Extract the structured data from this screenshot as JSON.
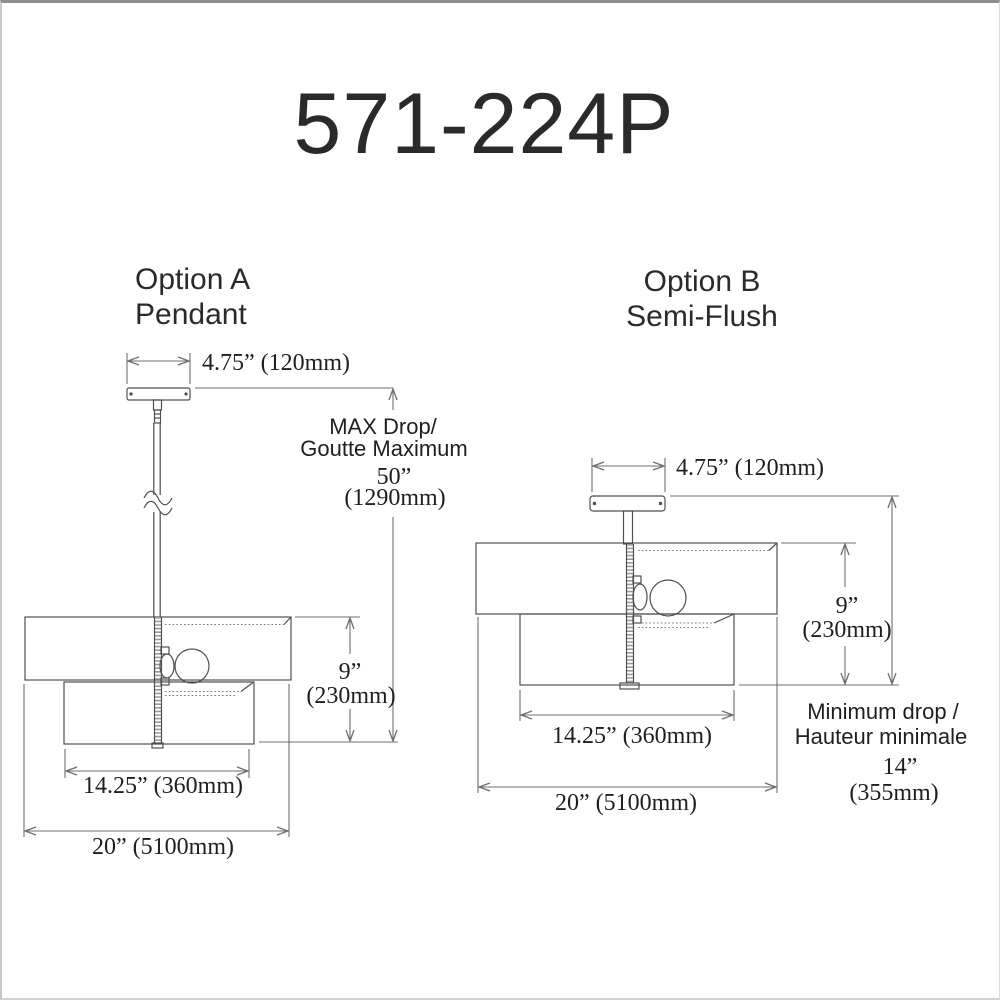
{
  "product_number": "571-224P",
  "colors": {
    "line": "#4f4f4f",
    "dimension_line": "#6f6f6f",
    "text": "#1f1f1f",
    "background": "#ffffff"
  },
  "option_a": {
    "name": "Option A",
    "mount": "Pendant",
    "canopy_width": "4.75” (120mm)",
    "max_drop_label_1": "MAX Drop/",
    "max_drop_label_2": "Goutte Maximum",
    "max_drop_in": "50”",
    "max_drop_mm": "(1290mm)",
    "shade_height_in": "9”",
    "shade_height_mm": "(230mm)",
    "shade_width": "14.25” (360mm)",
    "overall_width": "20” (5100mm)"
  },
  "option_b": {
    "name": "Option B",
    "mount": "Semi-Flush",
    "canopy_width": "4.75” (120mm)",
    "shade_height_in": "9”",
    "shade_height_mm": "(230mm)",
    "shade_width": "14.25” (360mm)",
    "overall_width": "20” (5100mm)",
    "min_drop_label_1": "Minimum drop /",
    "min_drop_label_2": "Hauteur minimale",
    "min_drop_in": "14”",
    "min_drop_mm": "(355mm)"
  }
}
